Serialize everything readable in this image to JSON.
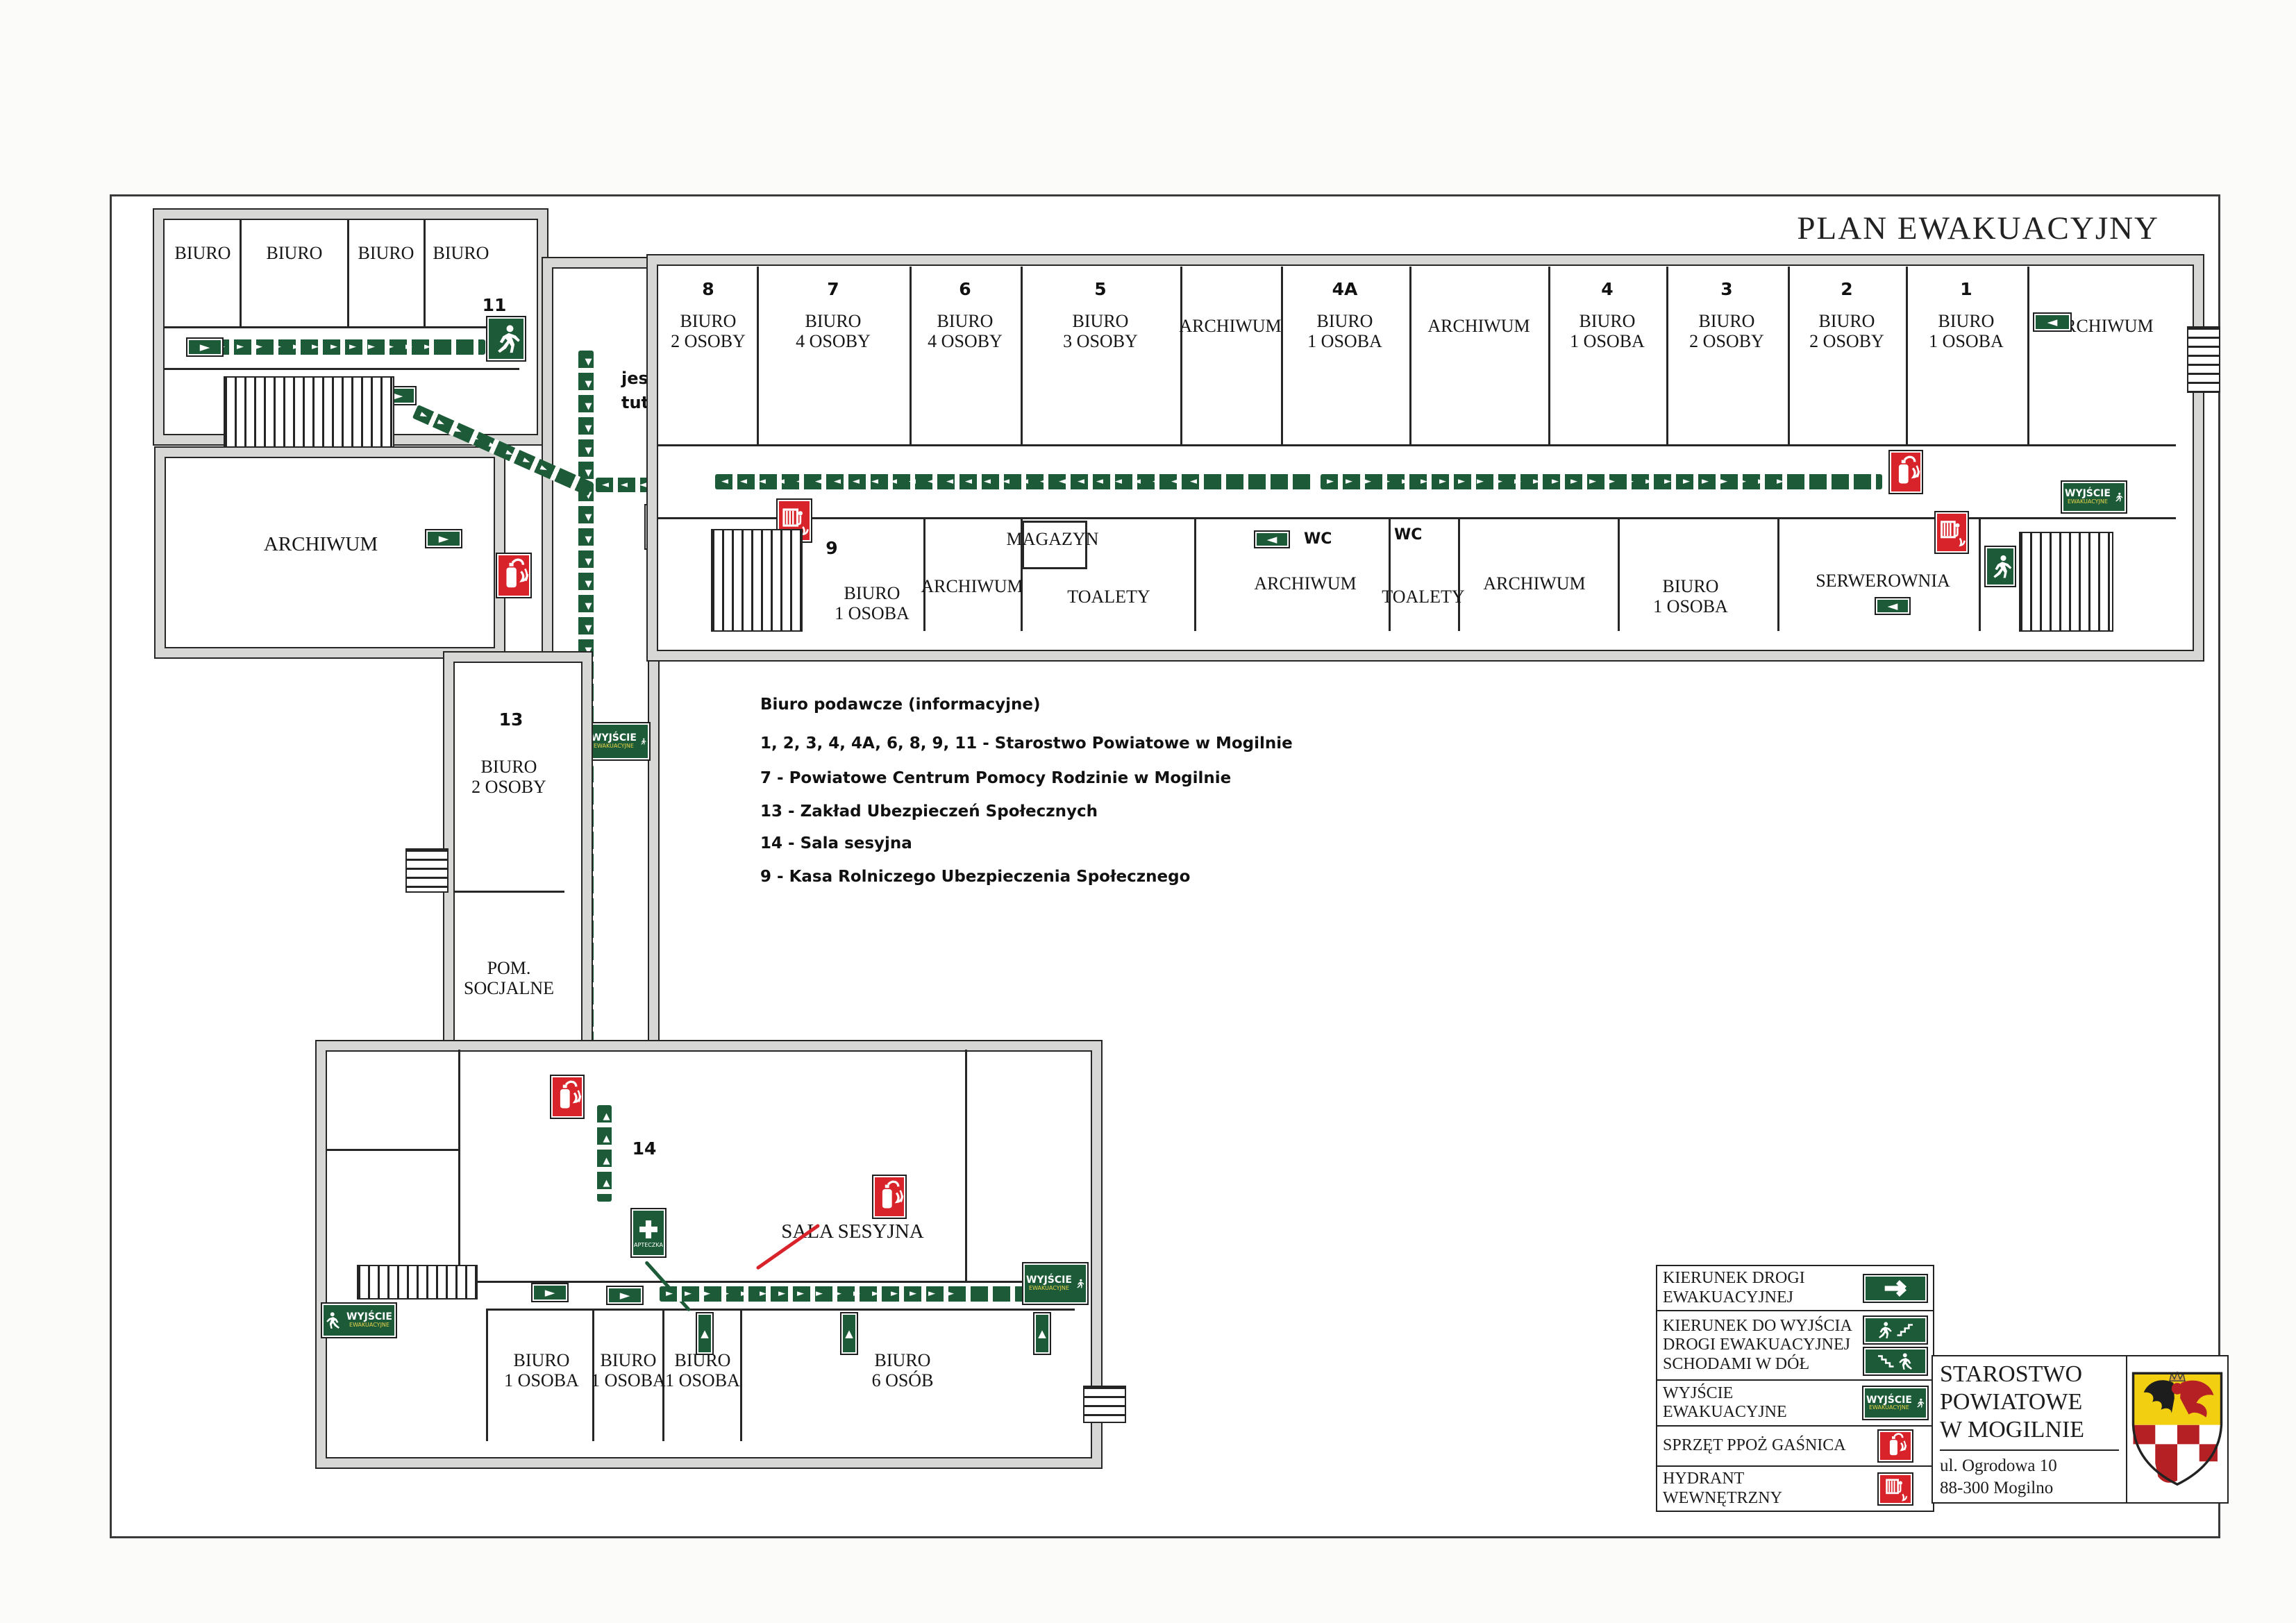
{
  "title": "PLAN EWAKUACYJNY",
  "you_are_here_l1": "jesteś",
  "you_are_here_l2": "tutaj",
  "icons": {
    "right": "►",
    "left": "◄",
    "up": "▲",
    "down": "▼"
  },
  "left_wing": {
    "r0": "BIURO",
    "r1": "BIURO",
    "r2": "BIURO",
    "r3": "BIURO",
    "exit_num": "11",
    "archive": "ARCHIWUM"
  },
  "top_row": [
    {
      "num": "8",
      "l1": "BIURO",
      "l2": "2 OSOBY"
    },
    {
      "num": "7",
      "l1": "BIURO",
      "l2": "4 OSOBY"
    },
    {
      "num": "6",
      "l1": "BIURO",
      "l2": "4 OSOBY"
    },
    {
      "num": "5",
      "l1": "BIURO",
      "l2": "3 OSOBY"
    },
    {
      "num": "",
      "l1": "ARCHIWUM",
      "l2": ""
    },
    {
      "num": "4A",
      "l1": "BIURO",
      "l2": "1 OSOBA"
    },
    {
      "num": "",
      "l1": "ARCHIWUM",
      "l2": ""
    },
    {
      "num": "4",
      "l1": "BIURO",
      "l2": "1 OSOBA"
    },
    {
      "num": "3",
      "l1": "BIURO",
      "l2": "2 OSOBY"
    },
    {
      "num": "2",
      "l1": "BIURO",
      "l2": "2 OSOBY"
    },
    {
      "num": "1",
      "l1": "BIURO",
      "l2": "1 OSOBA"
    },
    {
      "num": "",
      "l1": "ARCHIWUM",
      "l2": ""
    }
  ],
  "bottom_row": {
    "num9": "9",
    "b9l1": "BIURO",
    "b9l2": "1 OSOBA",
    "arch1": "ARCHIWUM",
    "magazyn": "MAGAZYN",
    "toalety1": "TOALETY",
    "arch2": "ARCHIWUM",
    "wc1": "WC",
    "wc2": "WC",
    "toalety2": "TOALETY",
    "arch3": "ARCHIWUM",
    "b1l1": "BIURO",
    "b1l2": "1 OSOBA",
    "serwerownia": "SERWEROWNIA"
  },
  "left_column": {
    "num": "13",
    "rl1": "BIURO",
    "rl2": "2 OSOBY",
    "sl1": "POM.",
    "sl2": "SOCJALNE"
  },
  "bottom_building": {
    "num": "14",
    "hall": "SALA SESYJNA",
    "rooms": [
      {
        "l1": "BIURO",
        "l2": "1 OSOBA"
      },
      {
        "l1": "BIURO",
        "l2": "1 OSOBA"
      },
      {
        "l1": "BIURO",
        "l2": "1 OSOBA"
      },
      {
        "l1": "BIURO",
        "l2": "6 OSÓB"
      }
    ]
  },
  "info": {
    "l0": "Biuro podawcze (informacyjne)",
    "l1": "1, 2, 3, 4, 4A, 6, 8, 9, 11 - Starostwo Powiatowe w Mogilnie",
    "l2": "7 - Powiatowe Centrum Pomocy Rodzinie w Mogilnie",
    "l3": "13 - Zakład Ubezpieczeń Społecznych",
    "l4": "14 - Sala sesyjna",
    "l5": "9 - Kasa Rolniczego Ubezpieczenia Społecznego"
  },
  "legend": {
    "r0": "KIERUNEK DROGI EWAKUACYJNEJ",
    "r1": "KIERUNEK DO WYJŚCIA DROGI EWAKUACYJNEJ SCHODAMI W DÓŁ",
    "r2": "WYJŚCIE EWAKUACYJNE",
    "r3": "SPRZĘT PPOŻ GAŚNICA",
    "r4": "HYDRANT WEWNĘTRZNY"
  },
  "exit_sign": {
    "l1": "WYJŚCIE",
    "l2": "EWAKUACYJNE"
  },
  "first_aid_label": "APTECZKA",
  "org": {
    "n1": "STAROSTWO",
    "n2": "POWIATOWE",
    "n3": "W MOGILNIE",
    "a1": "ul. Ogrodowa 10",
    "a2": "88-300 Mogilno"
  },
  "colors": {
    "green": "#1d5b38",
    "red": "#d8232a",
    "yellow": "#f3cf12"
  }
}
